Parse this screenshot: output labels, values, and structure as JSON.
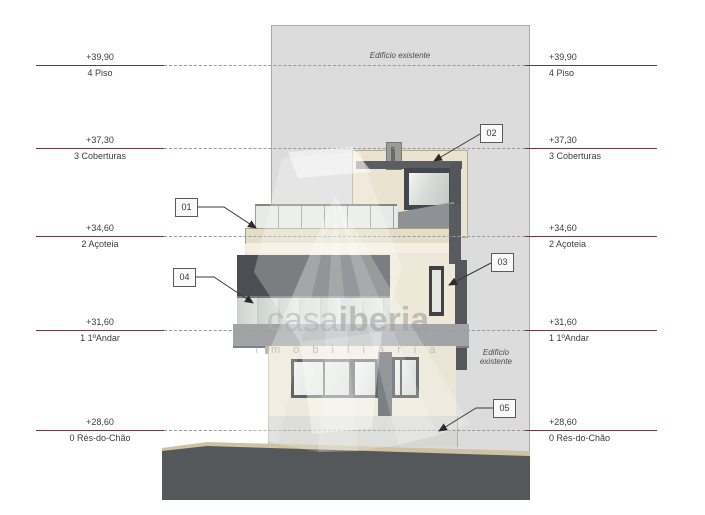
{
  "drawing": {
    "existing_building_top": "Edifício existente",
    "existing_building_side": {
      "line1": "Edifício",
      "line2": "existente"
    }
  },
  "levels": [
    {
      "value": "+39,90",
      "label": "4 Piso"
    },
    {
      "value": "+37,30",
      "label": "3 Coberturas"
    },
    {
      "value": "+34,60",
      "label": "2 Açoteia"
    },
    {
      "value": "+31,60",
      "label": "1 1ºAndar"
    },
    {
      "value": "+28,60",
      "label": "0 Rés-do-Chão"
    }
  ],
  "callouts": [
    {
      "label": "01"
    },
    {
      "label": "02"
    },
    {
      "label": "03"
    },
    {
      "label": "04"
    },
    {
      "label": "05"
    }
  ],
  "watermark": {
    "brand_light": "casa",
    "brand_bold": "iberia",
    "subtitle": "i m o b i l i á r i a"
  },
  "colors": {
    "level_line": "#6e3c3c",
    "panel_gray": "#dcdcdc",
    "building_cream": "#ece6d6",
    "frame_dark": "#3e4246",
    "ground_dark": "#55585b",
    "curb_tan": "#cdc3a2"
  }
}
